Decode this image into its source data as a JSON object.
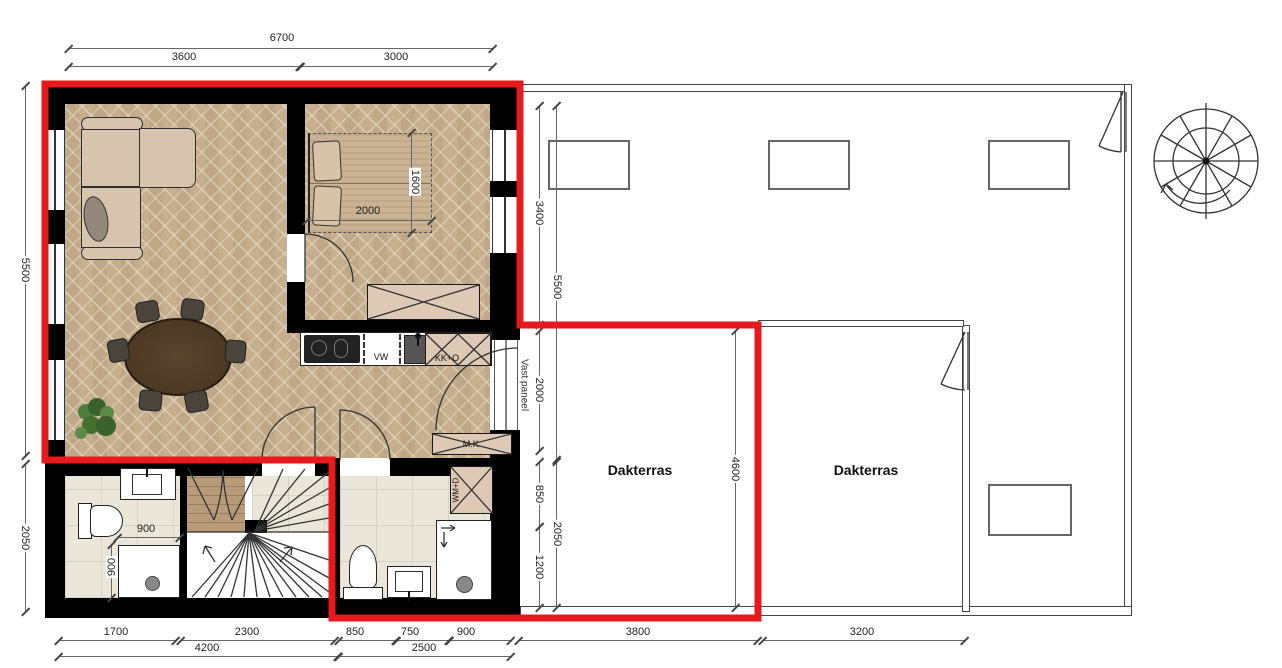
{
  "labels": {
    "vw": "VW",
    "kko": "KK+O",
    "mk": "M.K.",
    "wmd": "WM+D",
    "vast": "Vast paneel",
    "dak1": "Dakterras",
    "dak2": "Dakterras"
  },
  "dims": {
    "t6700": "6700",
    "t3600": "3600",
    "t3000": "3000",
    "l5500": "5500",
    "l2050": "2050",
    "m3400": "3400",
    "m5500": "5500",
    "m2000": "2000",
    "m850": "850",
    "m1200": "1200",
    "m2050": "2050",
    "m4600": "4600",
    "bed2000": "2000",
    "bed1600": "1600",
    "sh900w": "900",
    "sh900h": "900",
    "b1700": "1700",
    "b2300": "2300",
    "b4200": "4200",
    "b850": "850",
    "b750": "750",
    "b900": "900",
    "b2500": "2500",
    "b3800": "3800",
    "b3200": "3200"
  },
  "colors": {
    "highlight_red": "#e8191c",
    "wall_black": "#000000",
    "wood_floor": "#c6b090",
    "tile_floor": "#eae6da",
    "cabinet_beige": "#ddc9b5",
    "table_brown": "#4a3523",
    "plant_green": "#4e7c3c"
  }
}
